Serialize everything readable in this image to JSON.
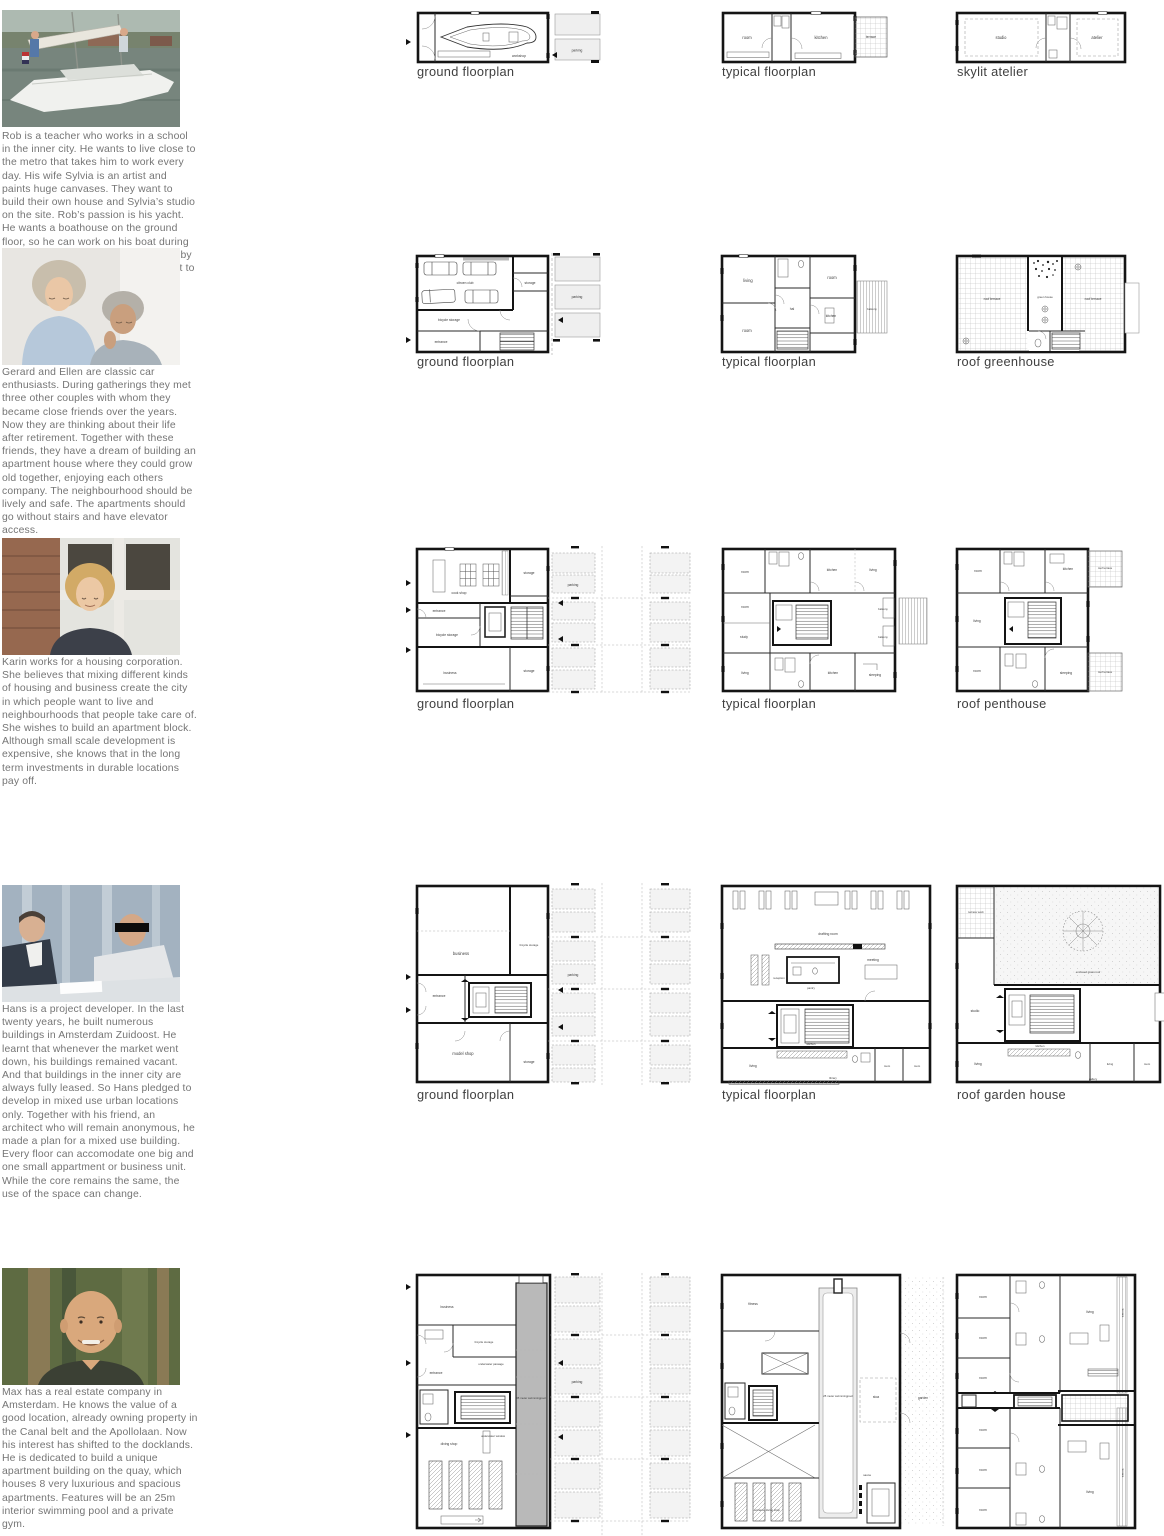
{
  "rows": [
    {
      "person": "rob",
      "description": "Rob is a teacher who works in a school in the inner city. He wants to live close to the metro that takes him to work every day. His wife Sylvia is an artist and paints huge canvases. They want to build their own house and Sylvia’s studio on the site. Rob’s passion is his yacht. He wants a boathouse on the ground floor, so he can work on his boat during the winter. In summertime, she wil lie by the quayside, so Rob can take her out to the IJsselmeer every weekend.",
      "plans": [
        {
          "label": "ground floorplan",
          "rooms": [
            "workshop",
            "parking"
          ]
        },
        {
          "label": "typical floorplan",
          "rooms": [
            "room",
            "kitchen",
            "terrace"
          ]
        },
        {
          "label": "skylit atelier",
          "rooms": [
            "studio",
            "atelier"
          ]
        }
      ]
    },
    {
      "person": "gerard-and-ellen",
      "description": "Gerard and Ellen are classic car enthusiasts. During gatherings they met three other couples with whom they became close friends over the years. Now they are thinking about their life after retirement. Together with these friends, they have a dream of building an apartment house where they could grow old together, enjoying each others company. The neighbourhood should be lively and safe. The apartments should go without stairs and have elevator access.",
      "plans": [
        {
          "label": "ground floorplan",
          "rooms": [
            "citroen club",
            "storage",
            "parking",
            "bicycle storage",
            "entrance"
          ]
        },
        {
          "label": "typical floorplan",
          "rooms": [
            "living",
            "room",
            "hal",
            "kitchen",
            "balcony",
            "room"
          ]
        },
        {
          "label": "roof greenhouse",
          "rooms": [
            "roof terrace",
            "green house",
            "roof terrace"
          ]
        }
      ]
    },
    {
      "person": "karin",
      "description": "Karin works for a housing corporation. She believes that mixing different kinds of housing and business create the city in which people want to live and neighbourhoods that people take care of. She wishes to build an apartment block. Although small scale development is expensive, she knows that in the long term investments in durable locations pay off.",
      "plans": [
        {
          "label": "ground floorplan",
          "rooms": [
            "cook shop",
            "storage",
            "parking",
            "entrance",
            "bicycle storage",
            "business",
            "storage"
          ]
        },
        {
          "label": "typical floorplan",
          "rooms": [
            "room",
            "kitchen",
            "living",
            "room",
            "study",
            "balcony",
            "balcony",
            "living",
            "kitchen",
            "sleeping"
          ]
        },
        {
          "label": "roof penthouse",
          "rooms": [
            "room",
            "kitchen",
            "roof terrace",
            "living",
            "room",
            "sleeping",
            "roof terrace"
          ]
        }
      ]
    },
    {
      "person": "hans",
      "description": "Hans is a project developer. In the last twenty years, he built numerous buildings in Amsterdam Zuidoost. He learnt that whenever the market went down, his buildings remained vacant. And that buildings in the inner city are always fully leased. So Hans pledged to develop in mixed use urban locations only. Together with his friend, an architect who will remain anonymous, he made a plan for a mixed use building. Every floor can accomodate one big and one small appartment or business unit. While the core remains the same, the use of the space can change.",
      "plans": [
        {
          "label": "ground floorplan",
          "rooms": [
            "business",
            "bicycle storage",
            "parking",
            "entrance",
            "model shop",
            "storage"
          ]
        },
        {
          "label": "typical floorplan",
          "rooms": [
            "drafting room",
            "reception",
            "pantry",
            "meeting",
            "living",
            "kitchen",
            "library",
            "room",
            "room"
          ]
        },
        {
          "label": "roof garden house",
          "rooms": [
            "terrace work",
            "enclosed grass roof",
            "studio",
            "living",
            "kitchen",
            "living",
            "room",
            "gallery"
          ]
        }
      ]
    },
    {
      "person": "max",
      "description": "Max has a real estate company in Amsterdam. He knows the value of a good location, already owning property in the Canal belt and the Apollolaan. Now his interest has shifted to the docklands. He is dedicated to build a unique apartment building on the quay, which houses 8 very luxurious and spacious apartments. Features will be an 25m interior swimming pool and a private gym.",
      "plans": [
        {
          "rooms": [
            "business",
            "bicycle storage",
            "underwater passage",
            "entrance",
            "35 meter swimmingpool",
            "parking",
            "underwater window",
            "diving shop"
          ]
        },
        {
          "rooms": [
            "fitness",
            "25 meter swimmingpool",
            "stoa",
            "garden",
            "sauna",
            "entrance diving shop"
          ]
        },
        {
          "rooms": [
            "room",
            "room",
            "room",
            "living",
            "terrace",
            "room",
            "room",
            "room",
            "living",
            "terrace"
          ]
        }
      ]
    }
  ]
}
